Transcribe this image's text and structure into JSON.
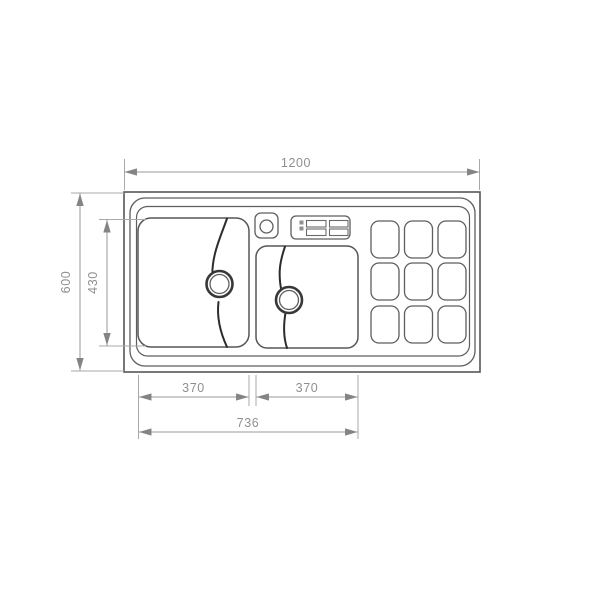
{
  "dimension_labels": {
    "overall_width": "1200",
    "overall_depth": "600",
    "bowl_depth": "430",
    "left_bowl_width": "370",
    "right_bowl_width": "370",
    "bowls_total_width": "736"
  },
  "colors": {
    "background": "#ffffff",
    "drawing_line": "#5e5e5e",
    "detail_line": "#2c2c2c",
    "dimension_line": "#9a9a9a",
    "dimension_text": "#8f8f8f",
    "arrowhead": "#848484"
  }
}
